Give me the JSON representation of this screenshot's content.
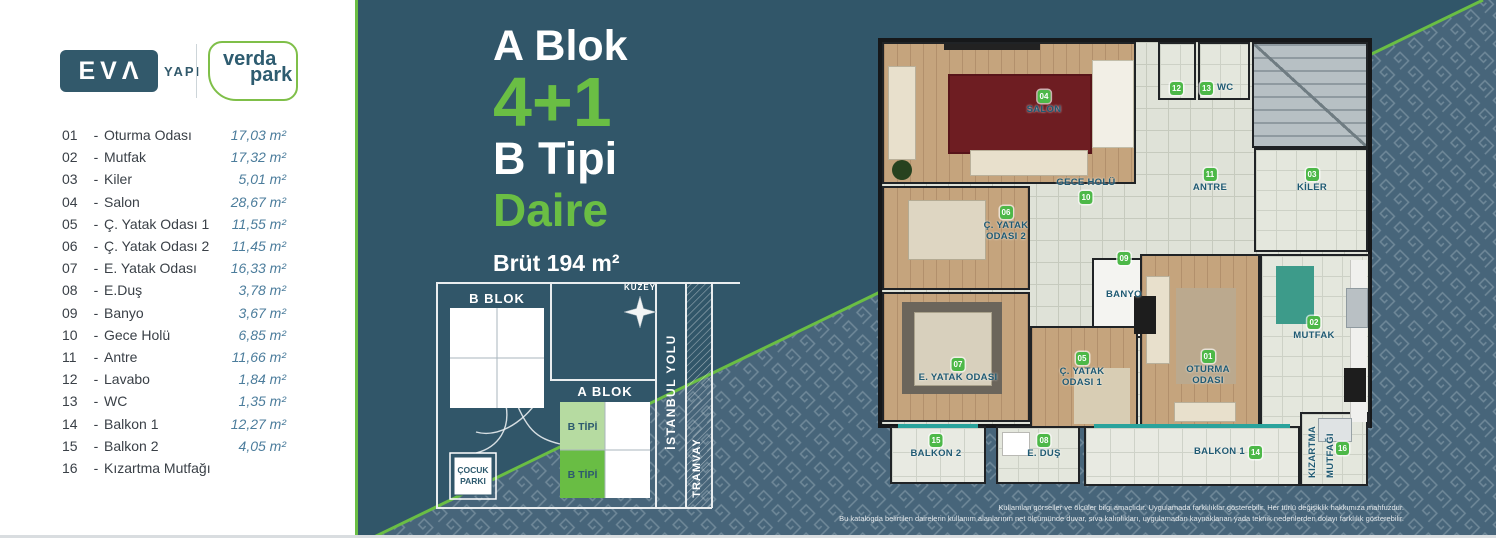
{
  "logos": {
    "eva": "EVΛ",
    "eva_sub": "YAPI",
    "verda_line1": "verda",
    "verda_line2": "park"
  },
  "legend": {
    "dash": "-",
    "items": [
      {
        "num": "01",
        "name": "Oturma Odası",
        "area": "17,03 m²"
      },
      {
        "num": "02",
        "name": "Mutfak",
        "area": "17,32 m²"
      },
      {
        "num": "03",
        "name": "Kiler",
        "area": "5,01 m²"
      },
      {
        "num": "04",
        "name": "Salon",
        "area": "28,67 m²"
      },
      {
        "num": "05",
        "name": "Ç. Yatak Odası 1",
        "area": "11,55 m²"
      },
      {
        "num": "06",
        "name": "Ç. Yatak Odası 2",
        "area": "11,45 m²"
      },
      {
        "num": "07",
        "name": "E. Yatak Odası",
        "area": "16,33 m²"
      },
      {
        "num": "08",
        "name": "E.Duş",
        "area": "3,78 m²"
      },
      {
        "num": "09",
        "name": "Banyo",
        "area": "3,67 m²"
      },
      {
        "num": "10",
        "name": "Gece Holü",
        "area": "6,85 m²"
      },
      {
        "num": "11",
        "name": "Antre",
        "area": "11,66 m²"
      },
      {
        "num": "12",
        "name": "Lavabo",
        "area": "1,84 m²"
      },
      {
        "num": "13",
        "name": "WC",
        "area": "1,35 m²"
      },
      {
        "num": "14",
        "name": "Balkon 1",
        "area": "12,27 m²"
      },
      {
        "num": "15",
        "name": "Balkon 2",
        "area": "4,05 m²"
      },
      {
        "num": "16",
        "name": "Kızartma Mutfağı",
        "area": ""
      }
    ]
  },
  "title": {
    "line1": "A Blok",
    "line2": "4+1",
    "line3": "B Tipi",
    "line4": "Daire",
    "gross": "Brüt 194 m²"
  },
  "siteplan": {
    "b_blok": "B BLOK",
    "a_blok": "A BLOK",
    "b_tipi_top": "B TİPİ",
    "b_tipi_bottom": "B TİPİ",
    "cocuk_line1": "ÇOCUK",
    "cocuk_line2": "PARKI",
    "kuzey": "KUZEY",
    "istanbul_yolu": "İSTANBUL YOLU",
    "tramvay": "TRAMVAY"
  },
  "floorplan": {
    "rooms": {
      "oturma": {
        "badge": "01",
        "label": "OTURMA ODASI"
      },
      "mutfak": {
        "badge": "02",
        "label": "MUTFAK"
      },
      "kiler": {
        "badge": "03",
        "label": "KİLER"
      },
      "salon": {
        "badge": "04",
        "label": "SALON"
      },
      "c_yatak_1": {
        "badge": "05",
        "label": "Ç. YATAK ODASI 1"
      },
      "c_yatak_2": {
        "badge": "06",
        "label": "Ç. YATAK ODASI 2"
      },
      "e_yatak": {
        "badge": "07",
        "label": "E. YATAK ODASI"
      },
      "e_dus": {
        "badge": "08",
        "label": "E. DUŞ"
      },
      "banyo": {
        "badge": "09",
        "label": "BANYO"
      },
      "gece_holu": {
        "badge": "10",
        "label": "GECE HOLÜ"
      },
      "antre": {
        "badge": "11",
        "label": "ANTRE"
      },
      "lavabo": {
        "badge": "12",
        "label": ""
      },
      "wc": {
        "badge": "13",
        "label": "WC"
      },
      "balkon_1": {
        "badge": "14",
        "label": "BALKON 1"
      },
      "balkon_2": {
        "badge": "15",
        "label": "BALKON 2"
      },
      "kizartma": {
        "badge": "16",
        "label": "KIZARTMA MUTFAĞI"
      }
    }
  },
  "disclaimer": {
    "line1": "Kullanılan görseller ve ölçüler bilgi amaçlıdır. Uygulamada farklılıklar gösterebilir. Her türlü değişiklik hakkımıza mahfuzdur.",
    "line2": "Bu katalogda belirtilen dairelerin kullanım alanlarının net ölçümünde duvar, sıva kalınlıkları, uygulamadan kaynaklanan yada teknik nedenlerden dolayı farklılık gösterebilir."
  },
  "colors": {
    "accent_green": "#6abe44",
    "badge_green": "#4db848",
    "teal_panel": "#315669",
    "pattern_base": "#47657a",
    "label_teal": "#1f5a73",
    "area_text": "#4c7d9c"
  }
}
